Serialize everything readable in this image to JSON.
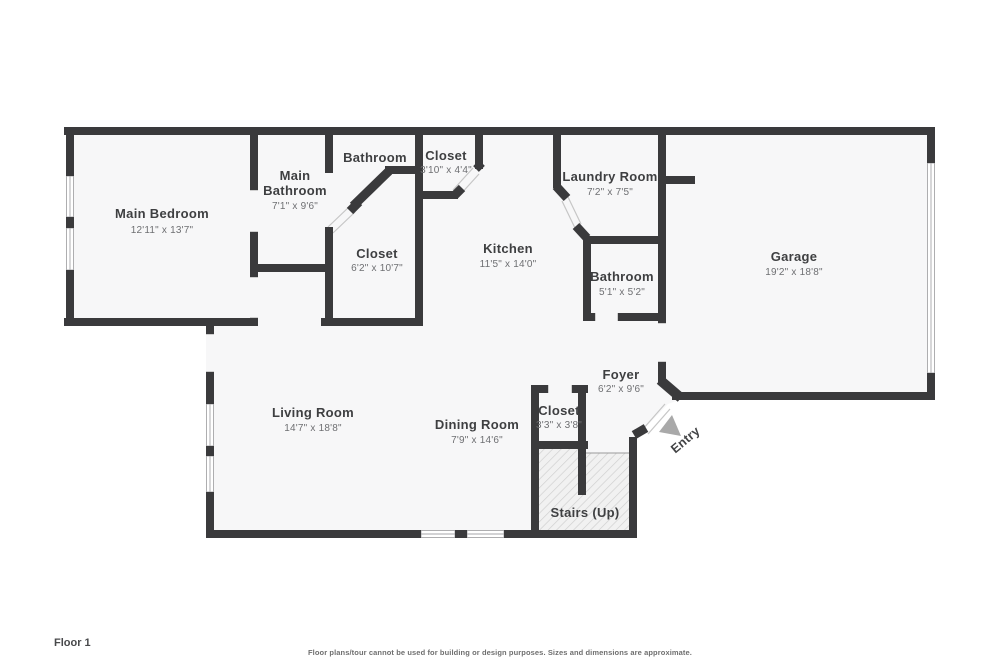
{
  "page": {
    "floor_label": "Floor 1",
    "disclaimer": "Floor plans/tour cannot be used for building or design purposes. Sizes and dimensions are approximate."
  },
  "colors": {
    "wall": "#3a3a3c",
    "room_fill": "#f7f7f8",
    "hatch_background": "#f1f1f1",
    "hatch_line": "#cfcfcf",
    "room_name_text": "#3e3f41",
    "room_dims_text": "#6e6f72",
    "entry_arrow": "#a9a9a9"
  },
  "rooms": {
    "main_bedroom": {
      "name": "Main Bedroom",
      "dims": "12'11\" x 13'7\""
    },
    "main_bathroom": {
      "name_line1": "Main",
      "name_line2": "Bathroom",
      "dims": "7'1\" x 9'6\""
    },
    "bathroom_top": {
      "name": "Bathroom"
    },
    "closet_top": {
      "name": "Closet",
      "dims": "3'10\" x 4'4\""
    },
    "closet_hall": {
      "name": "Closet",
      "dims": "6'2\" x 10'7\""
    },
    "kitchen": {
      "name": "Kitchen",
      "dims": "11'5\" x 14'0\""
    },
    "laundry": {
      "name": "Laundry Room",
      "dims": "7'2\" x 7'5\""
    },
    "bathroom_small": {
      "name": "Bathroom",
      "dims": "5'1\" x 5'2\""
    },
    "garage": {
      "name": "Garage",
      "dims": "19'2\" x 18'8\""
    },
    "living_room": {
      "name": "Living Room",
      "dims": "14'7\" x 18'8\""
    },
    "dining_room": {
      "name": "Dining Room",
      "dims": "7'9\" x 14'6\""
    },
    "closet_foyer": {
      "name": "Closet",
      "dims": "3'3\" x 3'8\""
    },
    "foyer": {
      "name": "Foyer",
      "dims": "6'2\" x 9'6\""
    },
    "stairs": {
      "name": "Stairs (Up)"
    },
    "entry": {
      "name": "Entry"
    }
  }
}
